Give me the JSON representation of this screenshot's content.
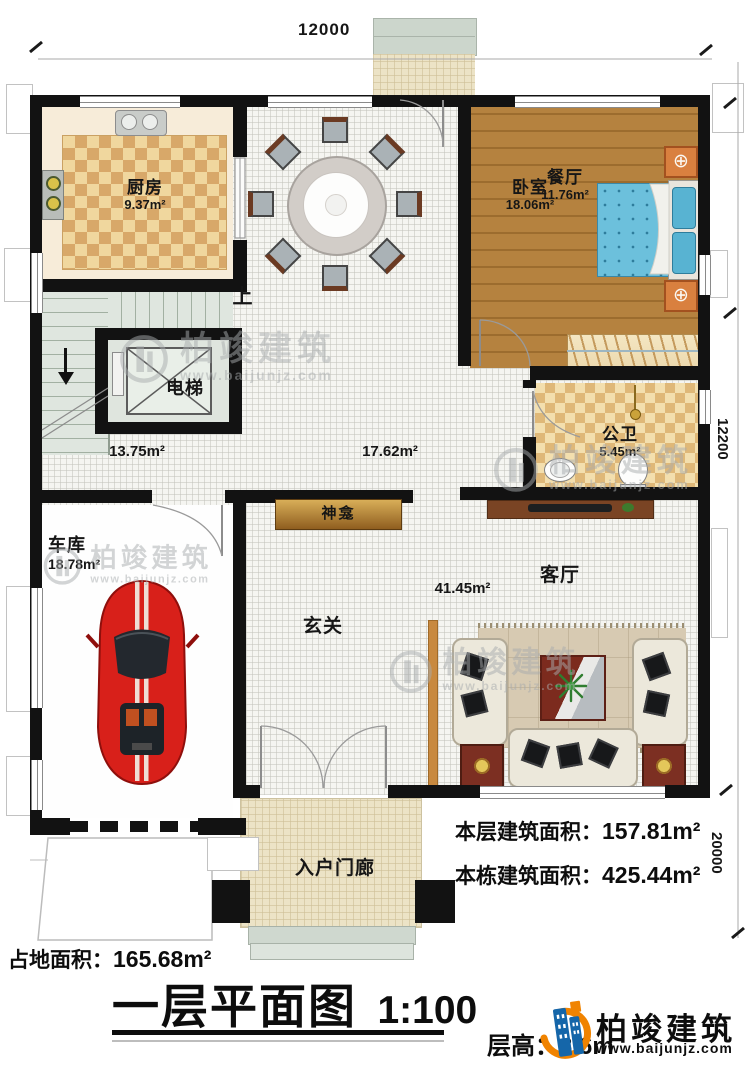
{
  "dims": {
    "top": "12000",
    "right_upper": "12200",
    "right_lower": "20000"
  },
  "rooms": {
    "kitchen": {
      "label": "厨房",
      "area": "9.37m²"
    },
    "dining": {
      "label": "餐厅",
      "area": "11.76m²"
    },
    "bedroom": {
      "label": "卧室",
      "area": "18.06m²"
    },
    "elevator": {
      "label": "电梯"
    },
    "bathroom": {
      "label": "公卫",
      "area": "5.45m²"
    },
    "garage": {
      "label": "车库",
      "area": "18.78m²"
    },
    "foyer": {
      "label": "玄关"
    },
    "living": {
      "label": "客厅",
      "area": "41.45m²"
    },
    "porch": {
      "label": "入户门廊"
    },
    "shrine": {
      "label": "神龛"
    },
    "stair_up": {
      "label": "上"
    },
    "open_area_left": {
      "area": "13.75m²"
    },
    "open_area_center": {
      "area": "17.62m²"
    }
  },
  "stats": {
    "floor_area": {
      "label": "本层建筑面积：",
      "value": "157.81m²"
    },
    "building_area": {
      "label": "本栋建筑面积：",
      "value": "425.44m²"
    },
    "land_area": {
      "label": "占地面积：",
      "value": "165.68m²"
    },
    "story_height": {
      "label": "层高：",
      "value": "3.6m"
    }
  },
  "title": {
    "main": "一层平面图",
    "scale": "1:100"
  },
  "brand": {
    "name": "柏竣建筑",
    "url": "www.baijunjz.com"
  },
  "watermark": {
    "name": "柏竣建筑",
    "url": "www.baijunjz.com"
  },
  "colors": {
    "accent_blue": "#1566a9",
    "accent_orange": "#f08300",
    "wall": "#121212"
  }
}
